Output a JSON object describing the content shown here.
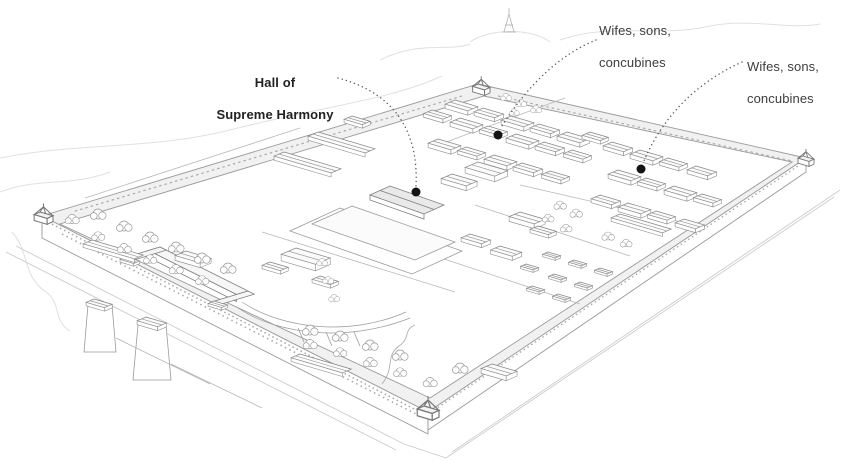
{
  "illustration": {
    "alt": "Hand-drawn isometric pen-and-ink bird's-eye illustration of the Forbidden City palace complex with outer walls, corner towers, moat, courtyards, halls, gardens and outer gate towers",
    "line_color": "#8d8d8d",
    "faint_color": "#dedede",
    "wall_fill": "#f1f1f1",
    "roof_shade": "#e9e9e9",
    "background": "#ffffff"
  },
  "style": {
    "dot_color": "#141414",
    "leader_color": "#5a5a5a",
    "label_color": "#3d3d3d",
    "label_bold_color": "#222222"
  },
  "annotations": [
    {
      "id": "hall-of-supreme-harmony",
      "lines": [
        "Hall of",
        "Supreme Harmony"
      ],
      "bold": true,
      "align": "center",
      "label_x": 210,
      "label_y": 59,
      "label_w": 130,
      "dot_x": 416,
      "dot_y": 192,
      "leader_path": "M 338,78 Q 420,100 416,186"
    },
    {
      "id": "wives-sons-concubines-north",
      "lines": [
        "Wifes, sons,",
        "concubines"
      ],
      "bold": false,
      "align": "left",
      "label_x": 599,
      "label_y": 7,
      "label_w": 110,
      "dot_x": 498,
      "dot_y": 135,
      "leader_path": "M 596,40 Q 542,62 500,129"
    },
    {
      "id": "wives-sons-concubines-east",
      "lines": [
        "Wifes, sons,",
        "concubines"
      ],
      "bold": false,
      "align": "left",
      "label_x": 747,
      "label_y": 43,
      "label_w": 110,
      "dot_x": 641,
      "dot_y": 169,
      "leader_path": "M 742,62 Q 672,94 643,163"
    }
  ]
}
